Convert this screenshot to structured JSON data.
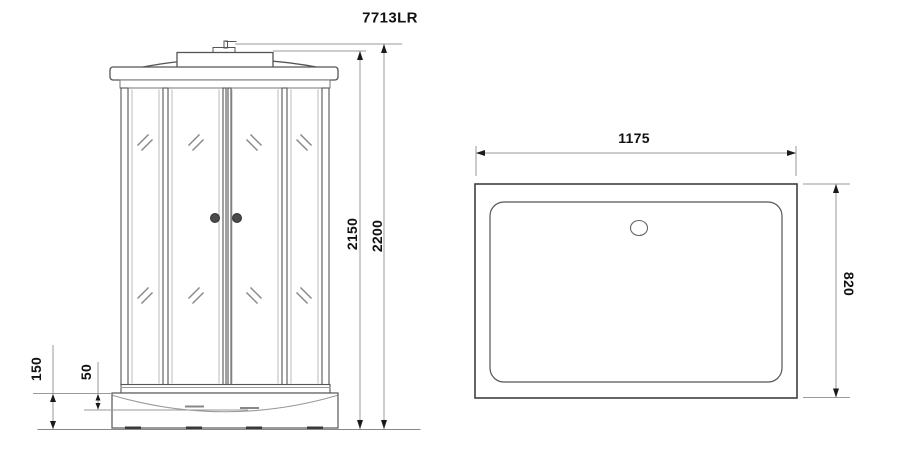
{
  "title": "7713LR",
  "front_view": {
    "name": "shower-cabin-front-view",
    "dims": {
      "cabin_height": "2150",
      "total_height": "2200",
      "base_height": "150",
      "tray_lip": "50"
    }
  },
  "top_view": {
    "name": "shower-tray-top-view",
    "dims": {
      "width": "1175",
      "depth": "820"
    }
  },
  "colors": {
    "line": "#4d4d4d",
    "light_line": "#999999",
    "arrow": "#1a1a1a",
    "text": "#111111",
    "background": "#ffffff"
  }
}
